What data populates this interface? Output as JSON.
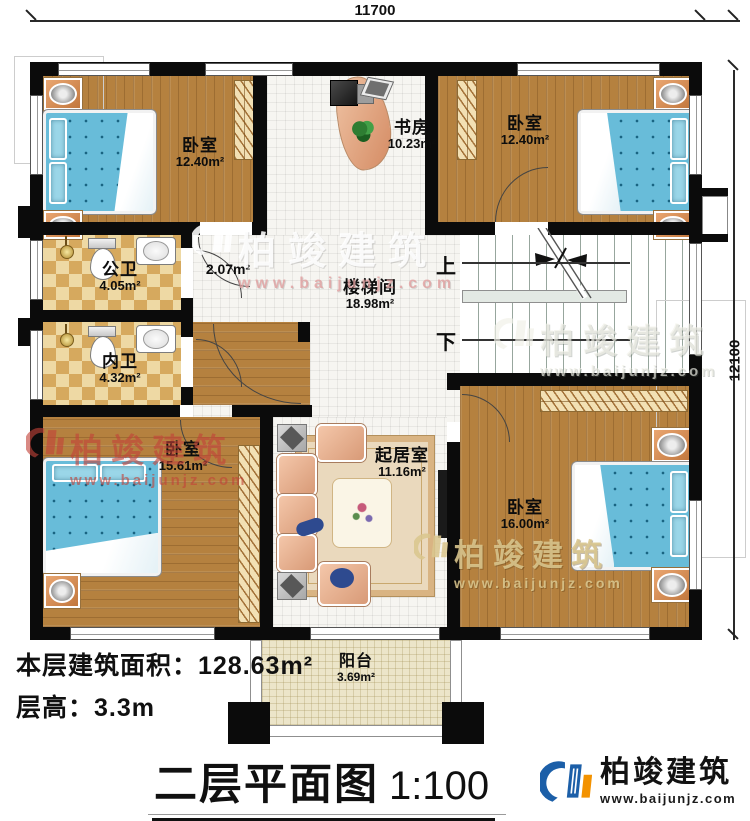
{
  "plan": {
    "dimensions": {
      "width_top": "11700",
      "height_right": "12100"
    },
    "rooms": {
      "bedroom_tl": {
        "name": "卧室",
        "area": "12.40m²"
      },
      "study": {
        "name": "书房",
        "area": "10.23m²"
      },
      "bedroom_tr": {
        "name": "卧室",
        "area": "12.40m²"
      },
      "public_bath": {
        "name": "公卫",
        "area": "4.05m²"
      },
      "hallway": {
        "area": "2.07m²"
      },
      "private_bath": {
        "name": "内卫",
        "area": "4.32m²"
      },
      "stairwell": {
        "name": "楼梯间",
        "area": "18.98m²"
      },
      "bedroom_bl": {
        "name": "卧室",
        "area": "15.61m²"
      },
      "living_room": {
        "name": "起居室",
        "area": "11.16m²"
      },
      "bedroom_br": {
        "name": "卧室",
        "area": "16.00m²"
      },
      "balcony": {
        "name": "阳台",
        "area": "3.69m²"
      }
    },
    "stairs": {
      "up_label": "上",
      "down_label": "下"
    }
  },
  "info": {
    "area_line": "本层建筑面积：128.63m²",
    "height_line": "层高：3.3m"
  },
  "title": {
    "name": "二层平面图",
    "scale": "1:100"
  },
  "brand": {
    "name": "柏竣建筑",
    "website": "www.baijunjz.com"
  },
  "watermark": {
    "name": "柏竣建筑",
    "website": "www.baijunjz.com"
  },
  "colors": {
    "wall": "#0b0b0b",
    "wood": "#b5813f",
    "tile": "#f6f5f1",
    "bath_tile": "#e9cf97",
    "stair": "#ccd6cf",
    "balcony": "#ece5c9",
    "bed": "#68bcd9",
    "brand_blue": "#1c5fa8",
    "brand_orange": "#f39200",
    "watermark_red": "#c24238"
  }
}
